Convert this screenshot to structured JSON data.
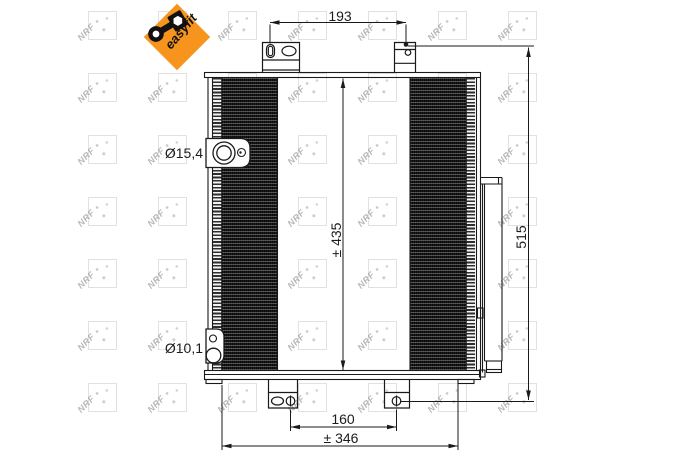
{
  "logo": {
    "brand_text": "easyfit",
    "background_color": "#f7941e",
    "icon": "wrench-icon"
  },
  "watermark": {
    "text": "NRF",
    "color": "#8a8a8a"
  },
  "drawing": {
    "line_color": "#1a1a1a",
    "dimensions": {
      "mount_spacing_top": "193",
      "core_height": "± 435",
      "overall_height": "515",
      "mount_spacing_bottom": "160",
      "overall_width": "± 346",
      "port_top_diameter": "Ø15,4",
      "port_bottom_diameter": "Ø10,1"
    }
  }
}
